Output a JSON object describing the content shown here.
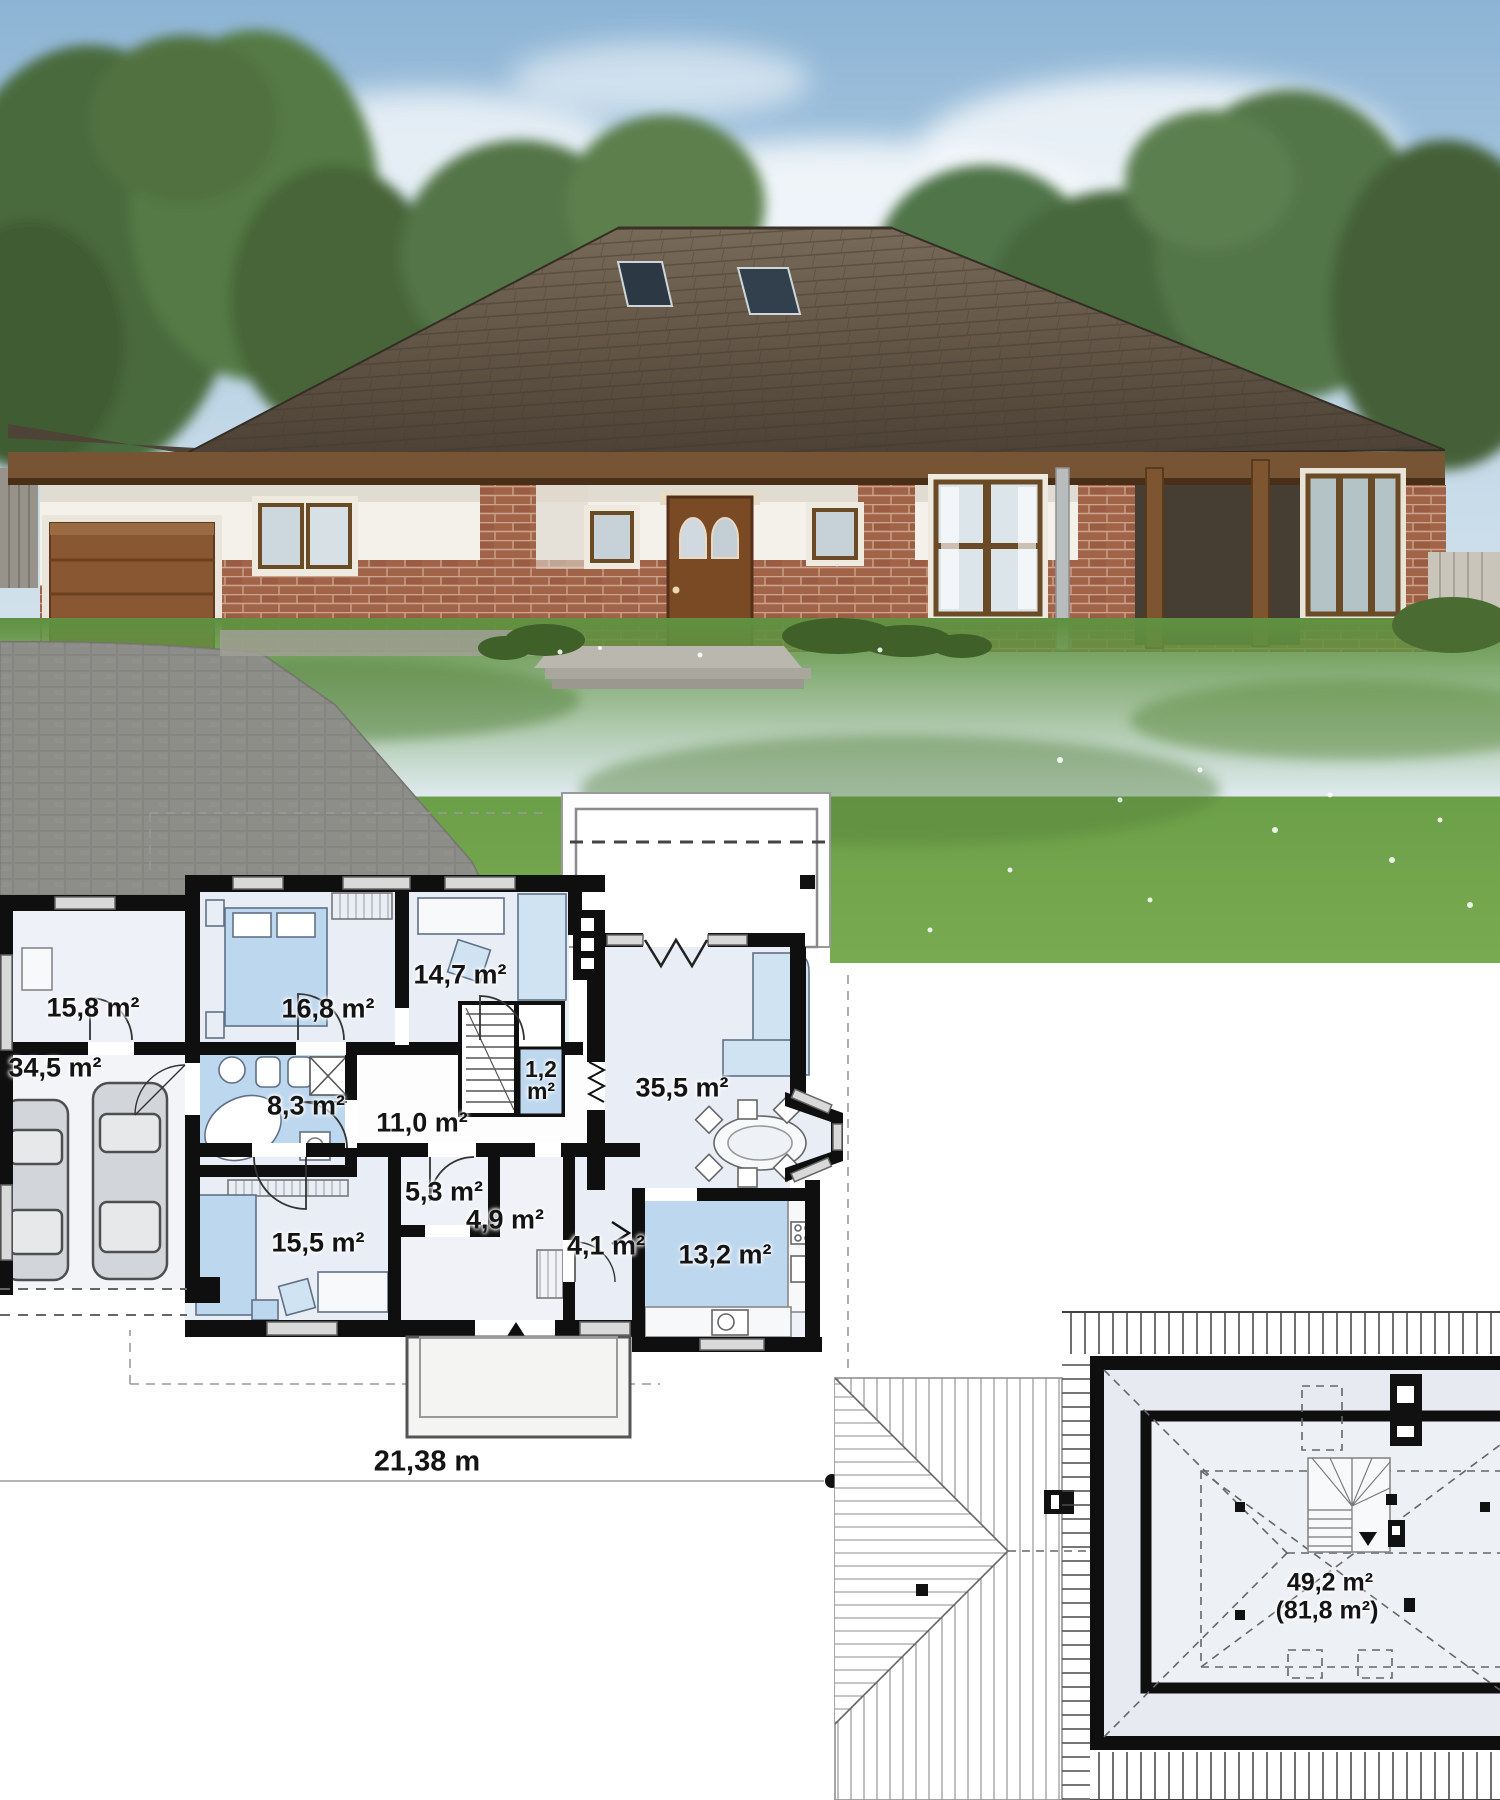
{
  "floor_plan": {
    "rooms": [
      {
        "name": "utility-room",
        "area": "15,8 m²"
      },
      {
        "name": "garage",
        "area": "34,5 m²"
      },
      {
        "name": "bedroom-1",
        "area": "16,8 m²"
      },
      {
        "name": "office",
        "area": "14,7 m²"
      },
      {
        "name": "bathroom",
        "area": "8,3 m²"
      },
      {
        "name": "hall",
        "area": "11,0 m²"
      },
      {
        "name": "stair-closet",
        "area": "1,2 m²"
      },
      {
        "name": "living-room",
        "area": "35,5 m²"
      },
      {
        "name": "bedroom-2",
        "area": "15,5 m²"
      },
      {
        "name": "wardrobe",
        "area": "5,3 m²"
      },
      {
        "name": "entry",
        "area": "4,9 m²"
      },
      {
        "name": "pantry",
        "area": "4,1 m²"
      },
      {
        "name": "kitchen",
        "area": "13,2 m²"
      }
    ],
    "overall_width": "21,38 m"
  },
  "attic_plan": {
    "usable_area": "49,2 m²",
    "gross_area": "(81,8 m²)"
  },
  "colors": {
    "plan_wall": "#0f0f0f",
    "room_fill": "#e9eef6",
    "wet_room_fill": "#bdd7ee",
    "roof_plan_fill": "#e7ebf1",
    "photo_roof": "#5b4e40",
    "brick": "#a26449",
    "wood": "#7b5836",
    "grass": "#6a9d45"
  }
}
